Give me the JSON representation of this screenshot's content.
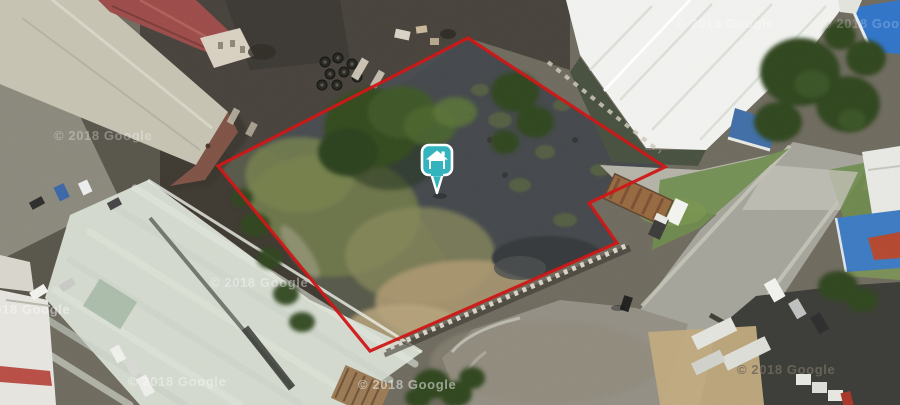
{
  "view": {
    "type": "aerial-satellite-map",
    "description": "Oblique aerial photo of an industrial area; a vacant dark plot is outlined in red with a teal house location pin at its centre"
  },
  "watermark": {
    "text": "© 2018 Google",
    "color": "#ffffff"
  },
  "boundary": {
    "points": "468,38 665,167 589,203 617,243 370,351 218,166",
    "color": "#cf1312",
    "stroke_width": 3.2
  },
  "marker": {
    "type": "house-pin",
    "icon": "house-icon",
    "transform": "translate(437,160)",
    "fill": "#33b3bd",
    "border": "#ffffff"
  },
  "palette": {
    "boundary_red": "#cf1312",
    "marker_teal": "#33b3bd",
    "burnt_ground": "#43474b",
    "warehouse_white": "#f2f3f0",
    "warehouse_green": "#d4dacf",
    "roof_red": "#9c4b49",
    "road_gray": "#a5a49b",
    "tree_green": "#2f451e",
    "canopy_blue": "#2f74c9"
  }
}
